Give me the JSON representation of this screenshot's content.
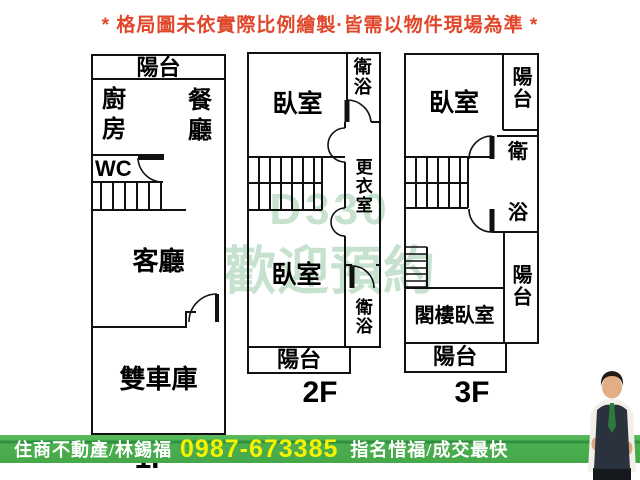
{
  "title": "* 格局圖未依實際比例繪製·皆需以物件現場為準 *",
  "watermark": {
    "line1": "D330",
    "line2": "歡迎預約"
  },
  "floors": {
    "f1": {
      "label": "1F",
      "balcony": "陽台",
      "kitchen": "廚房",
      "dining": "餐廳",
      "wc": "WC",
      "living": "客廳",
      "garage": "雙車庫"
    },
    "f2": {
      "label": "2F",
      "bedroom_top": "臥室",
      "bath_top": "衛浴",
      "closet": "更衣室",
      "bedroom_bottom": "臥室",
      "bath_bottom": "衛浴",
      "balcony": "陽台"
    },
    "f3": {
      "label": "3F",
      "bedroom": "臥室",
      "balcony_top": "陽台",
      "bath_char1": "衛",
      "bath_char2": "浴",
      "balcony_right": "陽台",
      "attic_bedroom": "閣樓臥室",
      "balcony_bottom": "陽台"
    }
  },
  "footer": {
    "agency": "住商不動產/林錫福",
    "phone": "0987-673385",
    "slogan": "指名惜福/成交最快"
  },
  "colors": {
    "title_red": "#e0472a",
    "bar_green": "#4bae4f",
    "phone_yellow": "#f6f300",
    "watermark_green": "#b9dcc3"
  }
}
